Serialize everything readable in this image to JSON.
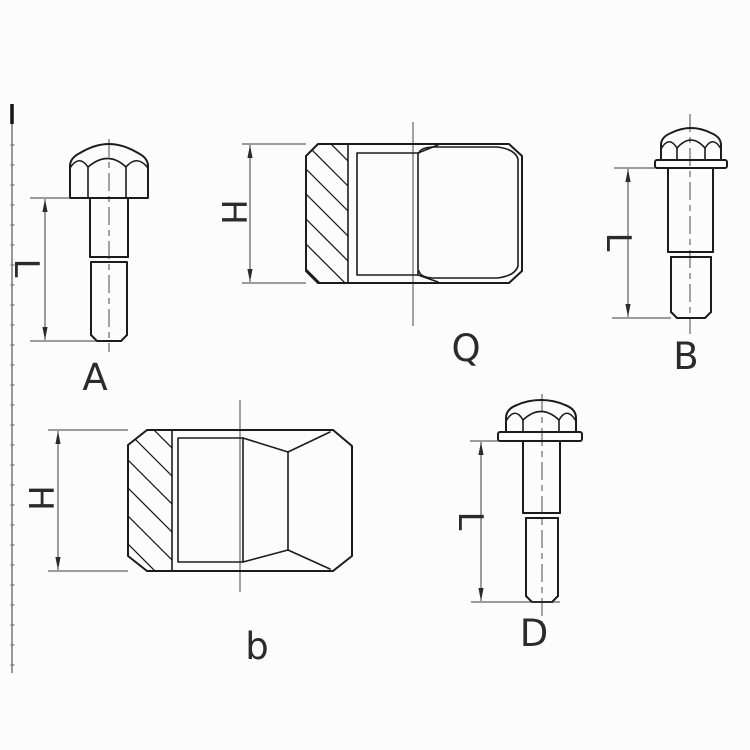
{
  "figures": {
    "bolt_a": {
      "label": "A",
      "dim": "L"
    },
    "nut_a": {
      "label": "Q",
      "dim": "H"
    },
    "bolt_b": {
      "label": "B",
      "dim": "L"
    },
    "nut_b": {
      "label": "b",
      "dim": "H"
    },
    "bolt_d": {
      "label": "D",
      "dim": "L"
    }
  },
  "colors": {
    "line": "#1c1c1c",
    "thin_line": "#3d3d3d",
    "background": "#fcfcfc"
  }
}
